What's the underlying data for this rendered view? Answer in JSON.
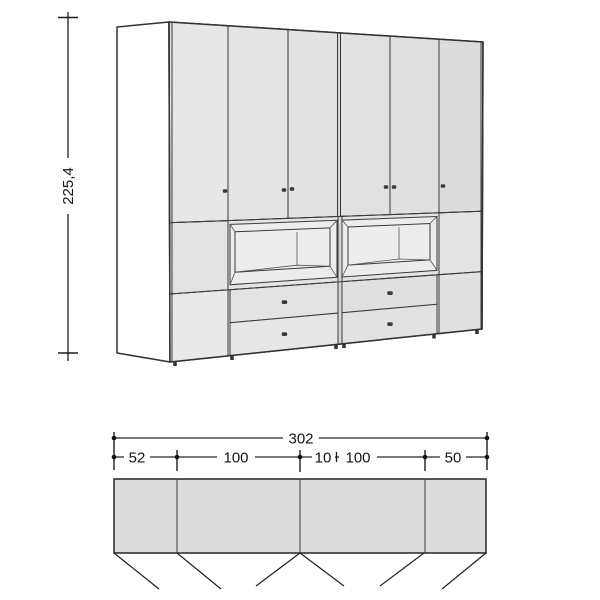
{
  "drawing": {
    "type": "furniture-technical-drawing",
    "views": [
      "elevation-3d",
      "plan-top-view"
    ]
  },
  "elevation": {
    "height": {
      "label": "225,4"
    }
  },
  "plan": {
    "total": {
      "label": "302"
    },
    "segments": [
      {
        "label": "52"
      },
      {
        "label": "100"
      },
      {
        "label": "10"
      },
      {
        "label": "100"
      },
      {
        "label": "50"
      }
    ]
  },
  "colors": {
    "door_front": "#e3e3e3",
    "accent_panel_left": "#b5b5b5",
    "accent_panel_right": "#aeaeae",
    "side_panel": "#ffffff",
    "niche_interior": "#ffffff",
    "plan_fill": "#dcdcdc",
    "line": "#333333"
  }
}
